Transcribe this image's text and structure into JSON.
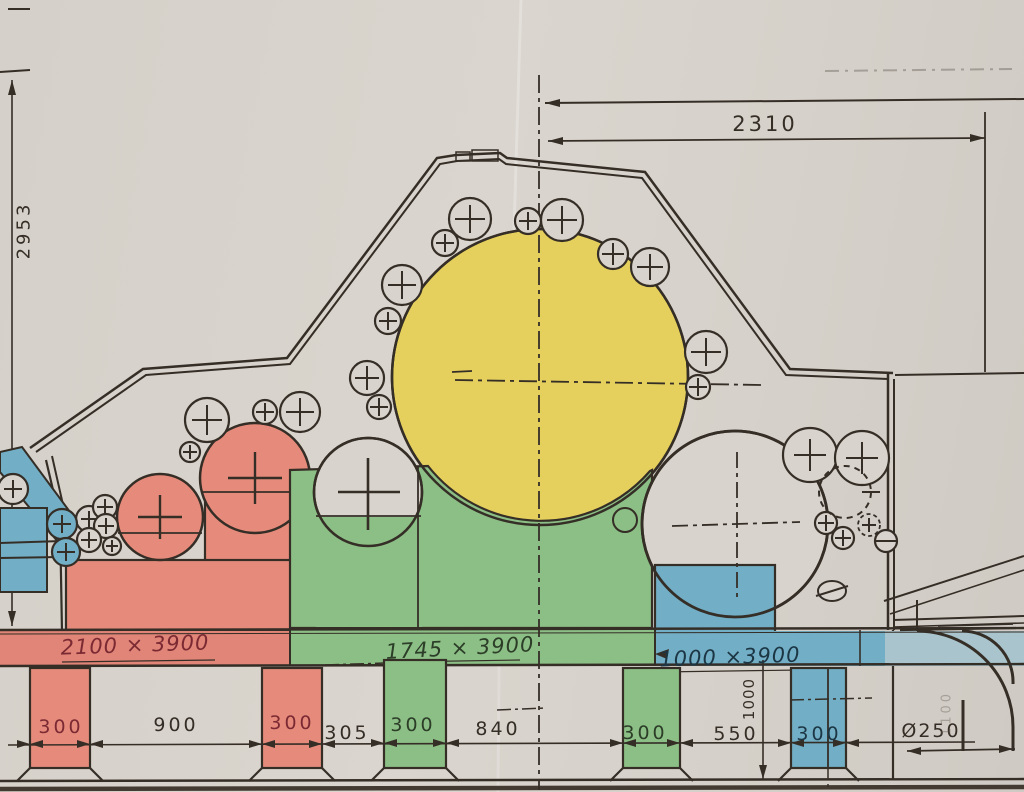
{
  "drawing": {
    "title": "machine-cross-section-hand-colored",
    "dims": {
      "top_width": "2310",
      "left_height": "2953",
      "vertical_height": "1000",
      "pipe_diameter": "Ø250",
      "faint_note": "1100"
    },
    "bands": {
      "red_label": "2100 × 3900",
      "green_label": "1745 × 3900",
      "blue_label": "1000 ×3900"
    },
    "bottom_dims": {
      "red_pillar_1": "300",
      "span_900": "900",
      "red_pillar_2": "300",
      "span_305": "305",
      "green_pillar_1": "300",
      "span_840": "840",
      "green_pillar_2": "300",
      "span_550": "550",
      "blue_pillar": "300"
    },
    "colors": {
      "paper": "#d8d3cc",
      "ink": "#352e27",
      "yellow_roll": "#e5d05e",
      "red_roll": "#e68b7b",
      "green_block": "#8cbf85",
      "blue_block": "#72aec5",
      "red_text": "#7b2a33",
      "green_text": "#2c3d28",
      "blue_text": "#1c3644"
    }
  }
}
